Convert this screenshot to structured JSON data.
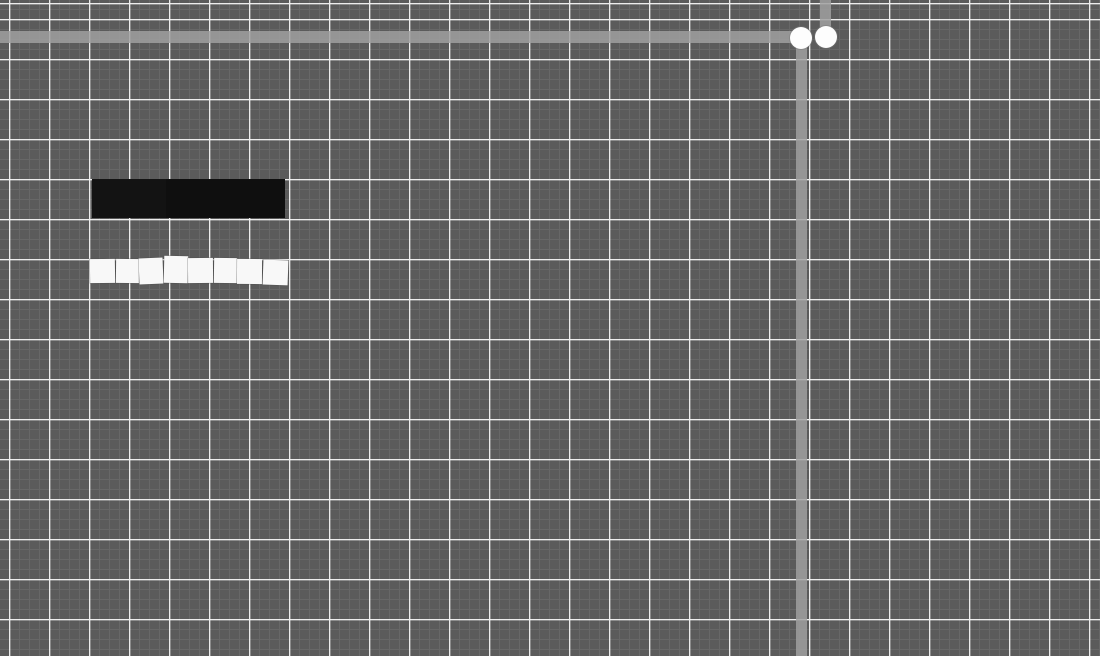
{
  "app": {
    "name": "physics-sandbox-canvas",
    "visible_text": ""
  },
  "canvas": {
    "width": 1100,
    "height": 656,
    "background": "#5b5b5b",
    "grid": {
      "minor_spacing": 10,
      "major_spacing": 40,
      "minor_color": "#676767",
      "major_color": "#ededed",
      "major_offset_x": 9,
      "major_offset_y": 19,
      "minor_offset_x": 9,
      "minor_offset_y": 9
    },
    "accent_colors": {
      "beam_gray": "rgba(160,160,160,0.85)",
      "ball_white": "#fdfdfd",
      "block_black": "#121212",
      "tile_white": "#f8f8f8"
    }
  },
  "objects": [
    {
      "type": "beam",
      "name": "horizontal-beam",
      "x": 0,
      "y": 31,
      "w": 795,
      "h": 12,
      "color": "rgba(160,160,160,0.85)"
    },
    {
      "type": "beam",
      "name": "top-vertical-beam",
      "x": 820,
      "y": 0,
      "w": 11,
      "h": 27,
      "color": "rgba(160,160,160,0.85)"
    },
    {
      "type": "beam",
      "name": "right-vertical-beam",
      "x": 796,
      "y": 44,
      "w": 11,
      "h": 612,
      "color": "rgba(160,160,160,0.85)"
    },
    {
      "type": "ball",
      "name": "pivot-ball-left",
      "cx": 801,
      "cy": 38,
      "r": 11,
      "color": "#fdfdfd"
    },
    {
      "type": "ball",
      "name": "pivot-ball-right",
      "cx": 826,
      "cy": 37,
      "r": 11,
      "color": "#fdfdfd"
    },
    {
      "type": "block",
      "name": "black-block-left",
      "x": 92,
      "y": 179,
      "w": 74,
      "h": 39,
      "color": "#131313"
    },
    {
      "type": "block",
      "name": "black-block-right",
      "x": 166,
      "y": 179,
      "w": 119,
      "h": 39,
      "color": "#0f0f0f"
    },
    {
      "type": "tile",
      "name": "white-tile-1",
      "x": 90,
      "y": 259,
      "w": 24.5,
      "h": 24,
      "rot": -0.8,
      "color": "#f8f8f8"
    },
    {
      "type": "tile",
      "name": "white-tile-2",
      "x": 115.5,
      "y": 259,
      "w": 23,
      "h": 24,
      "rot": 0.6,
      "color": "#f8f8f8"
    },
    {
      "type": "tile",
      "name": "white-tile-3",
      "x": 139,
      "y": 258,
      "w": 24,
      "h": 26,
      "rot": -2.2,
      "color": "#f8f8f8"
    },
    {
      "type": "tile",
      "name": "white-tile-4",
      "x": 163.5,
      "y": 255.5,
      "w": 24,
      "h": 27,
      "rot": 1.2,
      "color": "#f8f8f8"
    },
    {
      "type": "tile",
      "name": "white-tile-5",
      "x": 188,
      "y": 258,
      "w": 24.5,
      "h": 25,
      "rot": -0.5,
      "color": "#f8f8f8"
    },
    {
      "type": "tile",
      "name": "white-tile-6",
      "x": 213.5,
      "y": 257.5,
      "w": 23,
      "h": 25,
      "rot": 0.8,
      "color": "#f8f8f8"
    },
    {
      "type": "tile",
      "name": "white-tile-7",
      "x": 237,
      "y": 258.5,
      "w": 24.5,
      "h": 25,
      "rot": 0.3,
      "color": "#f8f8f8"
    },
    {
      "type": "tile",
      "name": "white-tile-8",
      "x": 262.5,
      "y": 259.5,
      "w": 25,
      "h": 25,
      "rot": 2.0,
      "color": "#f8f8f8"
    }
  ]
}
